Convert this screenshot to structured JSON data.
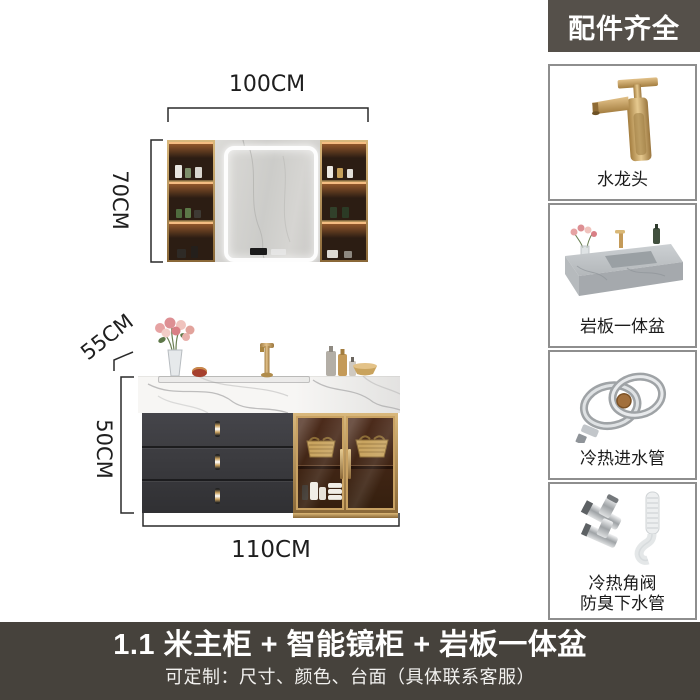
{
  "annotations": {
    "mirror_cabinet": {
      "width": "100CM",
      "height": "70CM"
    },
    "vanity_cabinet": {
      "depth": "55CM",
      "height": "50CM",
      "width": "110CM"
    }
  },
  "sidebar": {
    "header": "配件齐全",
    "items": [
      {
        "label": "水龙头",
        "icon": "gold-faucet"
      },
      {
        "label": "岩板一体盆",
        "icon": "stone-basin"
      },
      {
        "label": "冷热进水管",
        "icon": "braided-inlet-hoses"
      },
      {
        "label": "冷热角阀",
        "label2": "防臭下水管",
        "icon": "angle-valves-drain-pipe"
      }
    ]
  },
  "banner": {
    "title": "1.1 米主柜 + 智能镜柜 + 岩板一体盆",
    "subtitle": "可定制：尺寸、颜色、台面（具体联系客服）"
  },
  "colors": {
    "header_bg": "#55504a",
    "banner_bg": "#46423c",
    "gold_accent": "#c9a263",
    "drawer_gray": "#3a3a3c",
    "cabinet_wood": "#46281a",
    "marble_vein": "#adadad",
    "led_glow": "#ff9646"
  }
}
